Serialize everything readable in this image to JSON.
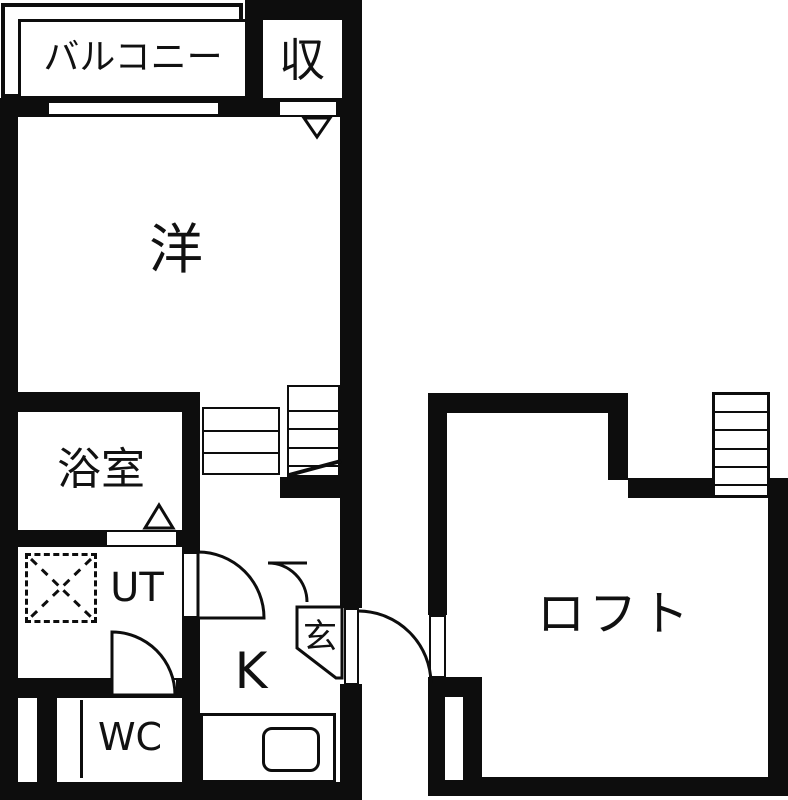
{
  "colors": {
    "wall": "#0d0d0d",
    "background": "#ffffff",
    "text": "#111111"
  },
  "rooms": {
    "balcony": {
      "label": "バルコニー"
    },
    "storage": {
      "label": "収"
    },
    "western_room": {
      "label": "洋"
    },
    "bathroom": {
      "label": "浴室"
    },
    "utility": {
      "label": "UT"
    },
    "toilet": {
      "label": "WC"
    },
    "kitchen": {
      "label": "K"
    },
    "entrance": {
      "label": "玄"
    },
    "loft": {
      "label": "ロフト"
    }
  }
}
